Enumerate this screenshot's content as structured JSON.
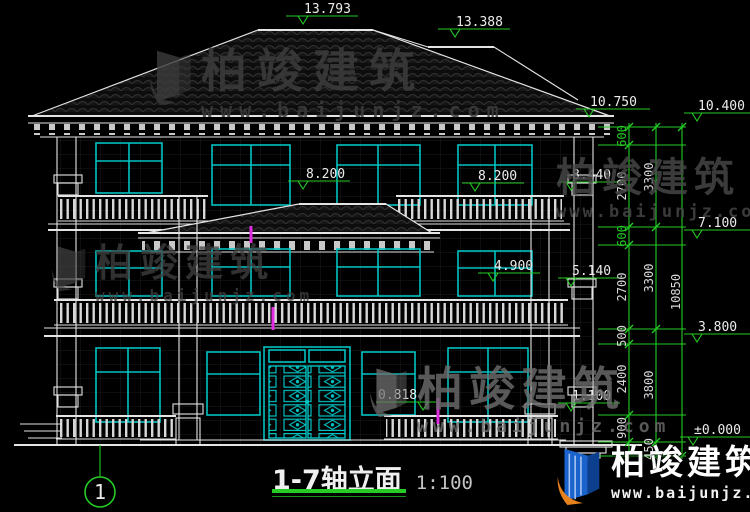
{
  "title": {
    "name": "1-7轴立面",
    "scale": "1:100"
  },
  "axis": {
    "label": "1"
  },
  "levels": {
    "ridge_main": "13.793",
    "ridge_wing": "13.388",
    "eave_top": "10.750",
    "eave_bottom": "10.400",
    "f3_parapet": "8.440",
    "f3_rail_left": "8.200",
    "f3_rail_right": "8.200",
    "canopy_eave": "7.100",
    "f2_parapet": "5.140",
    "f2_rail": "4.900",
    "f2_slab": "3.800",
    "f1_rail": "1.100",
    "porch": "0.818",
    "ground": "±0.000"
  },
  "dimensions": {
    "chain_inner": [
      "600",
      "2700",
      "600",
      "2700",
      "500",
      "2400",
      "900"
    ],
    "chain_mid": [
      "3300",
      "3300",
      "3800",
      "450"
    ],
    "chain_outer": [
      "10850"
    ]
  },
  "watermark": {
    "brand": "柏竣建筑",
    "url": "www.baijunjz.com"
  },
  "colors": {
    "line": "#e4e4e4",
    "window": "#00c2c2",
    "dimension": "#25cc25",
    "magenta": "#e02ce0",
    "wmgray": "#454545",
    "wmlight": "#6f6f6f",
    "logo_blue": "#1a63cc",
    "logo_orange": "#e8821e"
  }
}
